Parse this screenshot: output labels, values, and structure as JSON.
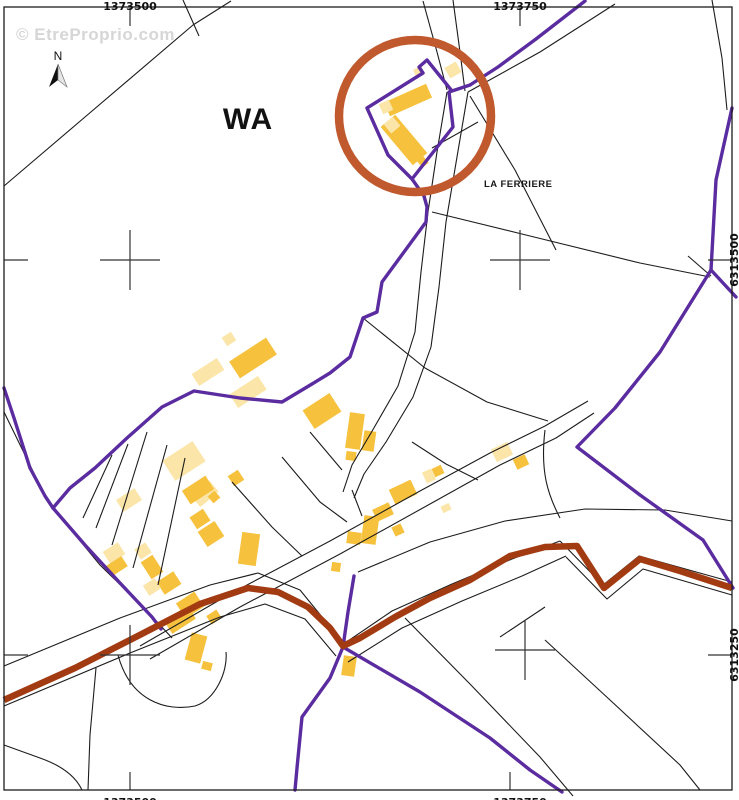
{
  "map": {
    "watermark": {
      "text": "© EtreProprio.com",
      "x": 16,
      "y": 40
    },
    "zone_label": {
      "text": "WA",
      "x": 248,
      "y": 129
    },
    "place_label": {
      "text": "LA FERRIERE",
      "x": 484,
      "y": 187
    },
    "north_arrow": {
      "label": "N",
      "x": 58,
      "y": 60
    },
    "colors": {
      "purple": "#5A2CA0",
      "route_brown": "#A33B12",
      "circle_orange": "#C05A2E",
      "building_dark": "#F6C23E",
      "building_light": "#FBE5A8",
      "line_black": "#1c1c1c",
      "grid_gray": "#333333",
      "watermark_gray": "#cccccc"
    },
    "geometry": {
      "frame": {
        "x": 4,
        "y": 7,
        "w": 728,
        "h": 783
      },
      "coord_labels": [
        {
          "text": "1373500",
          "x": 130,
          "y": 10,
          "rot": 0
        },
        {
          "text": "1373750",
          "x": 520,
          "y": 10,
          "rot": 0
        },
        {
          "text": "1373500",
          "x": 130,
          "y": 806,
          "rot": 0
        },
        {
          "text": "1373750",
          "x": 520,
          "y": 806,
          "rot": 0
        },
        {
          "text": "6313500",
          "x": 738,
          "y": 260,
          "rot": -90
        },
        {
          "text": "6313250",
          "x": 738,
          "y": 655,
          "rot": -90
        }
      ],
      "crosses": [
        [
          130,
          260
        ],
        [
          520,
          260
        ],
        [
          130,
          655
        ],
        [
          525,
          650
        ]
      ],
      "ticks": [
        [
          130,
          8,
          130,
          26
        ],
        [
          520,
          8,
          520,
          26
        ],
        [
          130,
          772,
          130,
          790
        ],
        [
          510,
          772,
          510,
          790
        ],
        [
          4,
          260,
          28,
          260
        ],
        [
          4,
          655,
          28,
          655
        ],
        [
          708,
          260,
          732,
          260
        ],
        [
          708,
          655,
          732,
          655
        ]
      ],
      "highlight_circle": {
        "cx": 415,
        "cy": 116,
        "r": 76
      },
      "brown_path": "M4,700 L75,668 L130,640 L200,604 L248,588 L278,592 L308,607 L330,628 L343,646 L360,638 L395,617 L430,598 L470,580 L510,556 L545,547 L577,546 L604,588 L640,559 L680,571 L732,588",
      "purple_paths": [
        "M585,1 L536,39 L498,67 L470,85",
        "M470,85 L452,91 L427,60 L419,67 L423,73 L367,108 L388,155 L412,179 L453,127 L449,92 Z",
        "M412,179 L424,196 L427,207 L426,222 L382,282 L377,312 L363,318 L350,357 L330,373 L312,384 L282,402 L240,398 L194,391 L162,407 L127,438 L95,468 L70,488 L53,508",
        "M4,388 L14,418 L30,468 L45,496 L53,508",
        "M53,508 L85,545 L120,583 L152,617 L161,629",
        "M354,576 L348,612 L343,647",
        "M343,647 L330,678 L302,717 L297,768 L295,790",
        "M343,647 L420,692 L490,738 L530,770 L562,792",
        "M732,108 L716,180 L711,270 L736,297",
        "M711,270 L660,352 L615,408 L577,447 L640,495 L703,540 L733,588"
      ],
      "parcel_paths": [
        "M183,0 L199,36",
        "M231,1 L193,25 L85,117 L4,186",
        "M615,4 L540,52 L468,92",
        "M423,1 L437,52 L447,90",
        "M453,0 L460,52 L465,91",
        "M447,92 L437,152 L428,212 L421,272 L415,332 L398,386 L371,433 L352,465 L343,492",
        "M468,92 L457,157 L446,222 L439,287 L431,347 L413,397 L386,442 L364,474 L354,498",
        "M140,646 L230,594 L330,541 L420,491 L490,453 L545,426 L588,401",
        "M150,659 L240,607 L340,554 L430,504 L500,465 L556,438 L594,413",
        "M363,318 L425,368 L487,402 L548,421",
        "M4,666 L120,618 L210,585 L258,573 L300,590 L331,628 L341,643",
        "M4,706 L130,653 L220,617 L265,604 L305,619 L336,656",
        "M345,643 L392,611 L452,584 L512,559 L560,541",
        "M348,662 L402,628 L462,601 L522,576 L566,556",
        "M560,541 L603,585 L639,556 L732,582",
        "M566,557 L607,599 L643,569 L732,595",
        "M358,572 L430,542 L505,521 L585,509 L665,510 L732,521",
        "M432,212 L530,236 L640,263 L710,277",
        "M688,256 L711,276",
        "M405,618 L470,684 L540,757 L573,796",
        "M4,412 L48,502 L100,565 L148,612 L172,638",
        "M112,455 L83,518",
        "M128,444 L96,528",
        "M147,432 L112,545",
        "M167,445 L133,568",
        "M185,458 L158,585",
        "M118,655 C130,700 165,712 195,706 C215,700 228,672 226,652",
        "M96,668 L90,735 L88,790",
        "M4,745 L40,758 C60,765 75,775 82,790",
        "M470,96 L515,170 L556,250",
        "M545,430 C540,472 548,495 560,518",
        "M500,637 L545,607",
        "M545,640 L610,700 L680,765 L700,790",
        "M712,0 L722,58 L727,110",
        "M310,432 L342,470",
        "M282,457 L320,502 L347,522",
        "M232,482 L272,527 L302,556",
        "M412,442 L446,464 L478,480",
        "M352,490 L362,516",
        "M432,148 L478,122"
      ],
      "buildings": [
        [
          408,
          100,
          46,
          15,
          -24,
          "D"
        ],
        [
          386,
          107,
          11,
          11,
          -24,
          "L"
        ],
        [
          419,
          72,
          9,
          9,
          -24,
          "L"
        ],
        [
          404,
          140,
          50,
          19,
          50,
          "D"
        ],
        [
          392,
          125,
          12,
          12,
          50,
          "L"
        ],
        [
          422,
          161,
          11,
          8,
          50,
          "D"
        ],
        [
          453,
          70,
          13,
          12,
          -30,
          "L"
        ],
        [
          229,
          339,
          11,
          10,
          -33,
          "L"
        ],
        [
          253,
          358,
          44,
          20,
          -33,
          "D"
        ],
        [
          208,
          372,
          30,
          14,
          -33,
          "L"
        ],
        [
          248,
          392,
          34,
          16,
          -33,
          "L"
        ],
        [
          322,
          411,
          32,
          22,
          -33,
          "D"
        ],
        [
          355,
          431,
          15,
          36,
          8,
          "D"
        ],
        [
          369,
          441,
          12,
          20,
          8,
          "D"
        ],
        [
          351,
          456,
          10,
          9,
          8,
          "D"
        ],
        [
          184,
          461,
          36,
          24,
          -33,
          "L"
        ],
        [
          236,
          478,
          12,
          12,
          -33,
          "D"
        ],
        [
          205,
          494,
          24,
          14,
          -40,
          "L"
        ],
        [
          214,
          497,
          9,
          9,
          -40,
          "D"
        ],
        [
          129,
          500,
          22,
          14,
          -33,
          "L"
        ],
        [
          403,
          492,
          24,
          16,
          -25,
          "D"
        ],
        [
          429,
          476,
          10,
          12,
          -25,
          "L"
        ],
        [
          438,
          471,
          10,
          9,
          -25,
          "D"
        ],
        [
          383,
          512,
          18,
          13,
          -25,
          "D"
        ],
        [
          398,
          530,
          10,
          10,
          -25,
          "D"
        ],
        [
          370,
          530,
          15,
          28,
          8,
          "D"
        ],
        [
          354,
          538,
          14,
          12,
          8,
          "D"
        ],
        [
          336,
          567,
          9,
          9,
          8,
          "D"
        ],
        [
          446,
          508,
          9,
          7,
          -25,
          "L"
        ],
        [
          502,
          452,
          18,
          14,
          -25,
          "L"
        ],
        [
          521,
          462,
          13,
          11,
          -25,
          "D"
        ],
        [
          198,
          490,
          28,
          16,
          -33,
          "D"
        ],
        [
          200,
          519,
          16,
          14,
          -33,
          "D"
        ],
        [
          211,
          534,
          20,
          18,
          -33,
          "D"
        ],
        [
          249,
          549,
          18,
          32,
          8,
          "D"
        ],
        [
          114,
          553,
          18,
          14,
          -33,
          "L"
        ],
        [
          117,
          566,
          18,
          12,
          -33,
          "D"
        ],
        [
          143,
          551,
          13,
          12,
          -33,
          "L"
        ],
        [
          152,
          567,
          14,
          20,
          -33,
          "D"
        ],
        [
          169,
          583,
          20,
          15,
          -33,
          "D"
        ],
        [
          152,
          587,
          14,
          12,
          -33,
          "L"
        ],
        [
          190,
          605,
          22,
          18,
          -33,
          "D"
        ],
        [
          214,
          617,
          12,
          10,
          -33,
          "D"
        ],
        [
          180,
          620,
          28,
          15,
          -33,
          "D"
        ],
        [
          196,
          648,
          16,
          28,
          15,
          "D"
        ],
        [
          207,
          666,
          10,
          8,
          15,
          "D"
        ],
        [
          349,
          666,
          13,
          20,
          8,
          "D"
        ]
      ]
    }
  }
}
